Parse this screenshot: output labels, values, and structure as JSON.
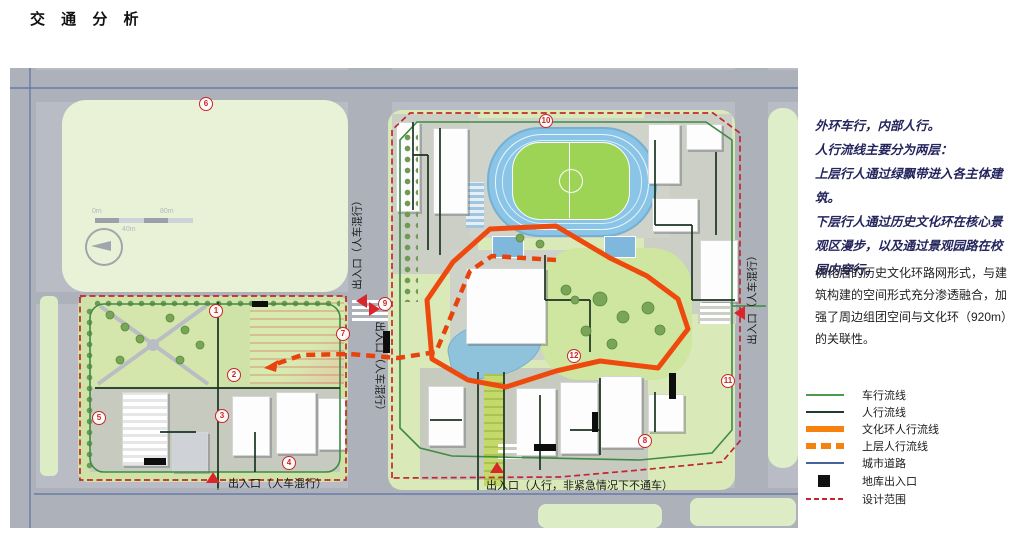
{
  "title": "交 通 分 析",
  "panel": {
    "bold_lines": [
      "外环车行，内部人行。",
      "人行流线主要分为两层：",
      "上层行人通过绿飘带进入各主体建筑。",
      "下层行人通过历史文化环在核心景观区漫步，以及通过景观园路在校园内穿行。"
    ],
    "body": "优化后的历史文化环路网形式，与建筑构建的空间形式充分渗透融合，加强了周边组团空间与文化环（920m）的关联性。"
  },
  "legend": {
    "items": [
      {
        "label": "车行流线",
        "swatch": "line",
        "color": "#4c9a4e"
      },
      {
        "label": "人行流线",
        "swatch": "line",
        "color": "#203c2a"
      },
      {
        "label": "文化环人行流线",
        "swatch": "thick",
        "color": "#f5820c"
      },
      {
        "label": "上层人行流线",
        "swatch": "thick-dashed",
        "color": "#f5820c"
      },
      {
        "label": "城市道路",
        "swatch": "line",
        "color": "#46639c"
      },
      {
        "label": "地库出入口",
        "swatch": "square",
        "color": "#111111"
      },
      {
        "label": "设计范围",
        "swatch": "dashed",
        "color": "#c2272d"
      }
    ]
  },
  "map": {
    "entrances": [
      {
        "id": "sw-south",
        "label": "出入口（人车混行）"
      },
      {
        "id": "campus-south",
        "label": "出入口（人行，非紧急情况下不通车）"
      },
      {
        "id": "mid-road-upper",
        "label": "出入口（人车混行）"
      },
      {
        "id": "mid-road-lower",
        "label": "出入口（人车混行）"
      },
      {
        "id": "campus-east",
        "label": "出入口（人车混行）"
      }
    ],
    "markers": [
      {
        "n": "1",
        "x": 215,
        "y": 310
      },
      {
        "n": "2",
        "x": 233,
        "y": 374
      },
      {
        "n": "3",
        "x": 221,
        "y": 415
      },
      {
        "n": "4",
        "x": 288,
        "y": 462
      },
      {
        "n": "5",
        "x": 98,
        "y": 417
      },
      {
        "n": "6",
        "x": 205,
        "y": 103
      },
      {
        "n": "7",
        "x": 342,
        "y": 333
      },
      {
        "n": "8",
        "x": 644,
        "y": 440
      },
      {
        "n": "9",
        "x": 384,
        "y": 303
      },
      {
        "n": "10",
        "x": 545,
        "y": 120
      },
      {
        "n": "11",
        "x": 727,
        "y": 380
      },
      {
        "n": "12",
        "x": 573,
        "y": 355
      }
    ],
    "scale_bar": {
      "labels": [
        "0m",
        "40m",
        "80m"
      ]
    }
  },
  "colors": {
    "ring_orange": "#ee4a0e",
    "legend_orange": "#f5820c",
    "design_red": "#c2272d",
    "vehicle_green": "#4c9a4e",
    "pedestrian_dark": "#203c2a",
    "city_blue": "#46639c",
    "marker_red": "#cc2428",
    "road_gray": "#b9bcc4",
    "field_green": "#e9f2d6"
  }
}
